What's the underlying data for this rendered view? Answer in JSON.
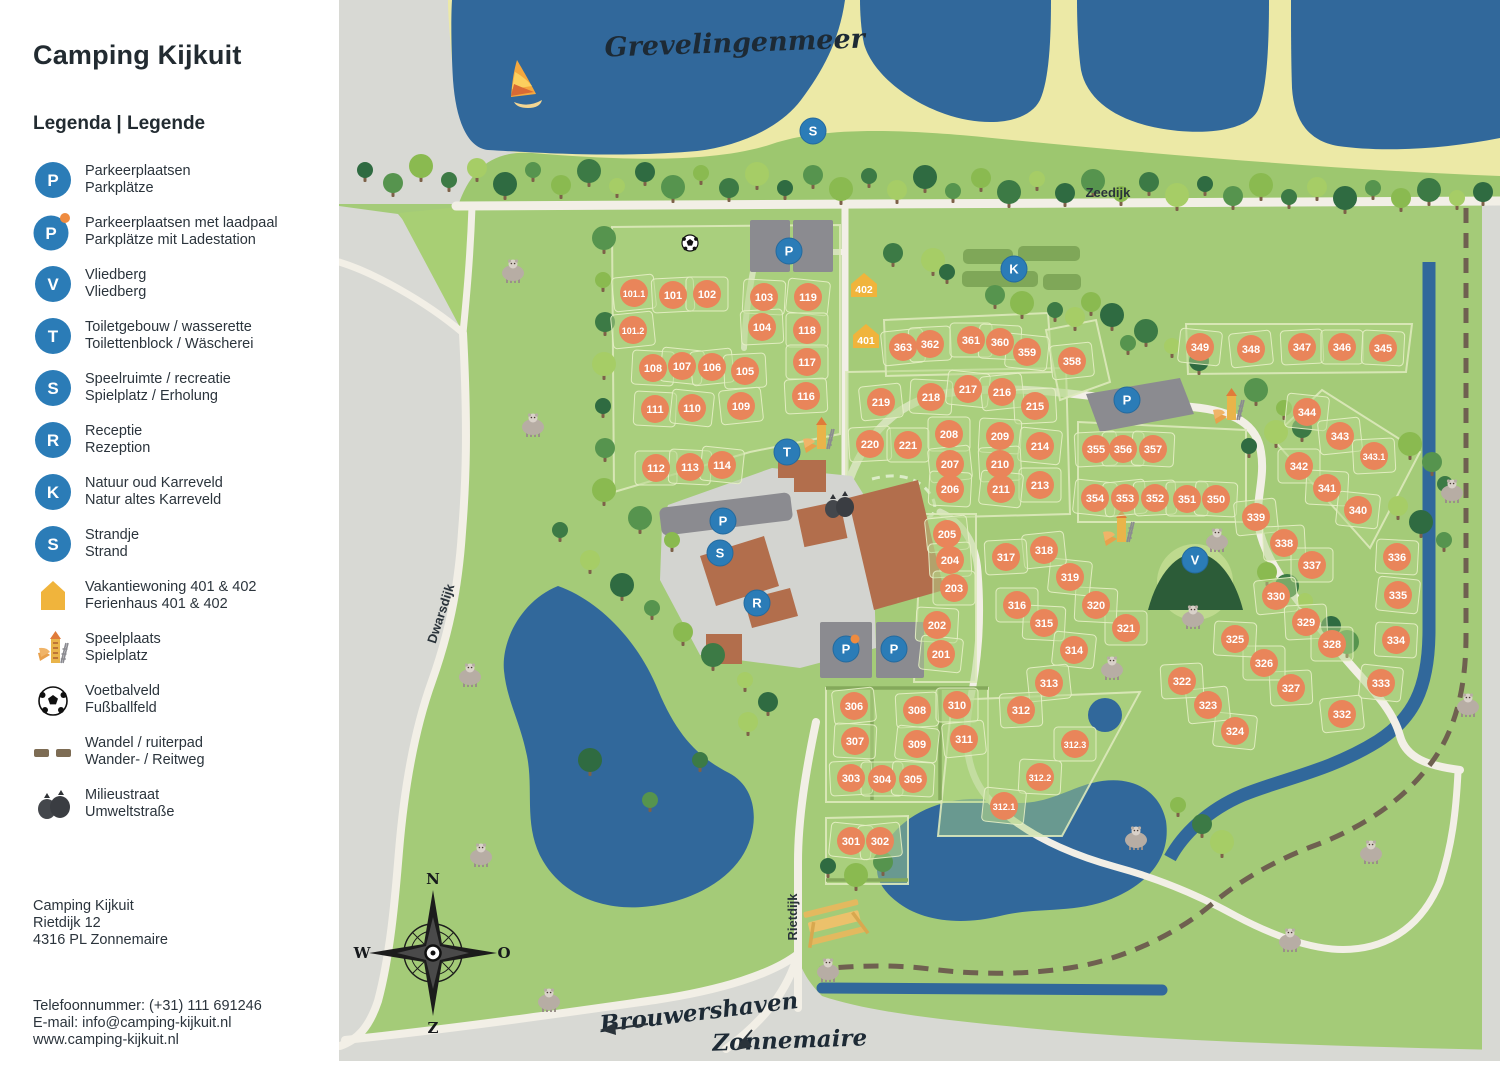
{
  "sidebar": {
    "title": "Camping Kijkuit",
    "legend_title": "Legenda | Legende",
    "items": [
      {
        "key": "parking",
        "icon": "badge",
        "letter": "P",
        "line1": "Parkeerplaatsen",
        "line2": "Parkplätze"
      },
      {
        "key": "parking-charging",
        "icon": "badge-dot",
        "letter": "P",
        "line1": "Parkeerplaatsen met laadpaal",
        "line2": "Parkplätze mit Ladestation"
      },
      {
        "key": "vliedberg",
        "icon": "badge",
        "letter": "V",
        "line1": "Vliedberg",
        "line2": "Vliedberg"
      },
      {
        "key": "toilets",
        "icon": "badge",
        "letter": "T",
        "line1": "Toiletgebouw / wasserette",
        "line2": "Toilettenblock / Wäscherei"
      },
      {
        "key": "recreation",
        "icon": "badge",
        "letter": "S",
        "line1": "Speelruimte / recreatie",
        "line2": "Spielplatz / Erholung"
      },
      {
        "key": "reception",
        "icon": "badge",
        "letter": "R",
        "line1": "Receptie",
        "line2": "Rezeption"
      },
      {
        "key": "karreveld",
        "icon": "badge",
        "letter": "K",
        "line1": "Natuur oud Karreveld",
        "line2": "Natur altes Karreveld"
      },
      {
        "key": "beach",
        "icon": "badge",
        "letter": "S",
        "line1": "Strandje",
        "line2": "Strand"
      },
      {
        "key": "holiday-home",
        "icon": "house",
        "letter": "",
        "line1": "Vakantiewoning 401 & 402",
        "line2": "Ferienhaus 401 & 402"
      },
      {
        "key": "playground",
        "icon": "playground",
        "letter": "",
        "line1": "Speelplaats",
        "line2": "Spielplatz"
      },
      {
        "key": "football-field",
        "icon": "soccer",
        "letter": "",
        "line1": "Voetbalveld",
        "line2": "Fußballfeld"
      },
      {
        "key": "bridle-path",
        "icon": "dashes",
        "letter": "",
        "line1": "Wandel / ruiterpad",
        "line2": "Wander- / Reitweg"
      },
      {
        "key": "waste-street",
        "icon": "trash",
        "letter": "",
        "line1": "Milieustraat",
        "line2": "Umweltstraße"
      }
    ],
    "address": [
      "Camping Kijkuit",
      "Rietdijk 12",
      "4316 PL Zonnemaire"
    ],
    "contact": [
      "Telefoonnummer: (+31) 111 691246",
      "E-mail: info@camping-kijkuit.nl",
      "www.camping-kijkuit.nl"
    ]
  },
  "map": {
    "labels": {
      "grevelingenmeer": "Grevelingenmeer",
      "zeedijk": "Zeedijk",
      "dwarsdijk": "Dwarsdijk",
      "rietdijk": "Rietdijk",
      "brouwershaven": "Brouwershaven",
      "zonnemaire": "Zonnemaire"
    },
    "compass": {
      "n": "N",
      "e": "O",
      "s": "Z",
      "w": "W"
    },
    "colors": {
      "water": "#31689b",
      "green": "#a4cb78",
      "dike_green": "#9dc76f",
      "sand": "#ece9a6",
      "outside_grey": "#d8d9d4",
      "road": "#f2efe6",
      "plot_orange": "#e9855a",
      "badge_blue": "#2b7cb7",
      "charge_dot": "#ef8b3f",
      "house_yellow": "#f0b43c",
      "building_brown": "#b26e4c",
      "parking_grey": "#8b8b90",
      "bridle_brown": "#6f6050",
      "hedge": "#7fa758",
      "vliedberg": "#2c5c38"
    },
    "plots": [
      [
        "101.1",
        634,
        293
      ],
      [
        "101",
        673,
        295
      ],
      [
        "102",
        707,
        294
      ],
      [
        "103",
        764,
        297
      ],
      [
        "119",
        808,
        297
      ],
      [
        "101.2",
        633,
        330
      ],
      [
        "104",
        762,
        327
      ],
      [
        "118",
        807,
        330
      ],
      [
        "108",
        653,
        368
      ],
      [
        "107",
        682,
        366
      ],
      [
        "106",
        712,
        367
      ],
      [
        "105",
        745,
        371
      ],
      [
        "117",
        807,
        362
      ],
      [
        "111",
        655,
        409
      ],
      [
        "110",
        692,
        408
      ],
      [
        "109",
        741,
        406
      ],
      [
        "116",
        806,
        396
      ],
      [
        "112",
        656,
        468
      ],
      [
        "113",
        690,
        467
      ],
      [
        "114",
        722,
        465
      ],
      [
        "219",
        881,
        402
      ],
      [
        "220",
        870,
        444
      ],
      [
        "221",
        908,
        445
      ],
      [
        "218",
        931,
        397
      ],
      [
        "217",
        968,
        389
      ],
      [
        "216",
        1002,
        392
      ],
      [
        "215",
        1035,
        406
      ],
      [
        "208",
        949,
        434
      ],
      [
        "209",
        1000,
        436
      ],
      [
        "214",
        1040,
        446
      ],
      [
        "207",
        950,
        464
      ],
      [
        "210",
        1000,
        464
      ],
      [
        "213",
        1040,
        485
      ],
      [
        "206",
        950,
        489
      ],
      [
        "211",
        1001,
        489
      ],
      [
        "205",
        947,
        534
      ],
      [
        "204",
        950,
        560
      ],
      [
        "203",
        954,
        588
      ],
      [
        "202",
        937,
        625
      ],
      [
        "201",
        941,
        654
      ],
      [
        "363",
        903,
        347
      ],
      [
        "362",
        930,
        344
      ],
      [
        "361",
        971,
        340
      ],
      [
        "360",
        1000,
        342
      ],
      [
        "359",
        1027,
        352
      ],
      [
        "358",
        1072,
        361
      ],
      [
        "355",
        1096,
        449
      ],
      [
        "356",
        1123,
        449
      ],
      [
        "357",
        1153,
        449
      ],
      [
        "354",
        1095,
        498
      ],
      [
        "353",
        1125,
        498
      ],
      [
        "352",
        1155,
        498
      ],
      [
        "351",
        1187,
        499
      ],
      [
        "350",
        1216,
        499
      ],
      [
        "349",
        1200,
        347
      ],
      [
        "348",
        1251,
        349
      ],
      [
        "347",
        1302,
        347
      ],
      [
        "346",
        1342,
        347
      ],
      [
        "345",
        1383,
        348
      ],
      [
        "344",
        1307,
        412
      ],
      [
        "343",
        1340,
        436
      ],
      [
        "343.1",
        1374,
        456
      ],
      [
        "342",
        1299,
        466
      ],
      [
        "341",
        1327,
        488
      ],
      [
        "340",
        1358,
        510
      ],
      [
        "339",
        1256,
        517
      ],
      [
        "338",
        1284,
        543
      ],
      [
        "337",
        1312,
        565
      ],
      [
        "336",
        1397,
        557
      ],
      [
        "335",
        1398,
        595
      ],
      [
        "330",
        1276,
        596
      ],
      [
        "329",
        1306,
        622
      ],
      [
        "328",
        1332,
        644
      ],
      [
        "334",
        1396,
        640
      ],
      [
        "333",
        1381,
        683
      ],
      [
        "332",
        1342,
        714
      ],
      [
        "327",
        1291,
        688
      ],
      [
        "326",
        1264,
        663
      ],
      [
        "325",
        1235,
        639
      ],
      [
        "324",
        1235,
        731
      ],
      [
        "323",
        1208,
        705
      ],
      [
        "322",
        1182,
        681
      ],
      [
        "321",
        1126,
        628
      ],
      [
        "320",
        1096,
        605
      ],
      [
        "319",
        1070,
        577
      ],
      [
        "318",
        1044,
        550
      ],
      [
        "317",
        1006,
        557
      ],
      [
        "316",
        1017,
        605
      ],
      [
        "315",
        1044,
        623
      ],
      [
        "314",
        1074,
        650
      ],
      [
        "313",
        1049,
        683
      ],
      [
        "312",
        1021,
        710
      ],
      [
        "312.3",
        1075,
        744
      ],
      [
        "312.2",
        1040,
        777
      ],
      [
        "312.1",
        1004,
        806
      ],
      [
        "306",
        854,
        706
      ],
      [
        "308",
        917,
        710
      ],
      [
        "310",
        957,
        705
      ],
      [
        "307",
        855,
        741
      ],
      [
        "309",
        917,
        744
      ],
      [
        "311",
        964,
        739
      ],
      [
        "303",
        851,
        778
      ],
      [
        "304",
        882,
        779
      ],
      [
        "305",
        913,
        779
      ],
      [
        "301",
        851,
        841
      ],
      [
        "302",
        880,
        841
      ]
    ],
    "holiday_homes": [
      [
        "402",
        864,
        287
      ],
      [
        "401",
        866,
        338
      ]
    ],
    "badges": [
      {
        "letter": "S",
        "x": 813,
        "y": 131,
        "name": "beach"
      },
      {
        "letter": "P",
        "x": 789,
        "y": 251,
        "name": "parking-north"
      },
      {
        "letter": "K",
        "x": 1014,
        "y": 269,
        "name": "karreveld"
      },
      {
        "letter": "P",
        "x": 1127,
        "y": 400,
        "name": "parking-east"
      },
      {
        "letter": "T",
        "x": 787,
        "y": 452,
        "name": "toilets"
      },
      {
        "letter": "P",
        "x": 723,
        "y": 521,
        "name": "parking-plaza"
      },
      {
        "letter": "S",
        "x": 720,
        "y": 553,
        "name": "recreation"
      },
      {
        "letter": "R",
        "x": 757,
        "y": 603,
        "name": "reception"
      },
      {
        "letter": "P",
        "x": 846,
        "y": 649,
        "dot": true,
        "name": "parking-charging"
      },
      {
        "letter": "P",
        "x": 894,
        "y": 649,
        "name": "parking-south"
      },
      {
        "letter": "V",
        "x": 1195,
        "y": 560,
        "name": "vliedberg"
      }
    ],
    "trees": [
      [
        365,
        170
      ],
      [
        393,
        183
      ],
      [
        421,
        166
      ],
      [
        449,
        180
      ],
      [
        477,
        168
      ],
      [
        505,
        184
      ],
      [
        533,
        170
      ],
      [
        561,
        185
      ],
      [
        589,
        171
      ],
      [
        617,
        186
      ],
      [
        645,
        172
      ],
      [
        673,
        187
      ],
      [
        701,
        173
      ],
      [
        729,
        188
      ],
      [
        757,
        174
      ],
      [
        785,
        188
      ],
      [
        813,
        175
      ],
      [
        841,
        189
      ],
      [
        869,
        176
      ],
      [
        897,
        190
      ],
      [
        925,
        177
      ],
      [
        953,
        191
      ],
      [
        981,
        178
      ],
      [
        1009,
        192
      ],
      [
        1037,
        179
      ],
      [
        1065,
        193
      ],
      [
        1093,
        181
      ],
      [
        1121,
        194
      ],
      [
        1149,
        182
      ],
      [
        1177,
        195
      ],
      [
        1205,
        184
      ],
      [
        1233,
        196
      ],
      [
        1261,
        185
      ],
      [
        1289,
        197
      ],
      [
        1317,
        187
      ],
      [
        1345,
        198
      ],
      [
        1373,
        188
      ],
      [
        1401,
        198
      ],
      [
        1429,
        190
      ],
      [
        1457,
        198
      ],
      [
        1483,
        192
      ],
      [
        604,
        238
      ],
      [
        603,
        280
      ],
      [
        605,
        322
      ],
      [
        604,
        364
      ],
      [
        603,
        406
      ],
      [
        605,
        448
      ],
      [
        604,
        490
      ],
      [
        560,
        530
      ],
      [
        590,
        560
      ],
      [
        622,
        585
      ],
      [
        652,
        608
      ],
      [
        683,
        632
      ],
      [
        713,
        655
      ],
      [
        745,
        680
      ],
      [
        768,
        702
      ],
      [
        640,
        518
      ],
      [
        672,
        540
      ],
      [
        893,
        253
      ],
      [
        933,
        260
      ],
      [
        947,
        272
      ],
      [
        995,
        295
      ],
      [
        1022,
        303
      ],
      [
        1055,
        310
      ],
      [
        1075,
        317
      ],
      [
        1112,
        315
      ],
      [
        1128,
        343
      ],
      [
        1091,
        302
      ],
      [
        1146,
        331
      ],
      [
        1172,
        346
      ],
      [
        1199,
        361
      ],
      [
        1256,
        390
      ],
      [
        1284,
        408
      ],
      [
        1302,
        428
      ],
      [
        1276,
        432
      ],
      [
        1249,
        446
      ],
      [
        1432,
        462
      ],
      [
        1410,
        444
      ],
      [
        1445,
        484
      ],
      [
        1398,
        506
      ],
      [
        1421,
        522
      ],
      [
        1444,
        540
      ],
      [
        1267,
        572
      ],
      [
        1287,
        586
      ],
      [
        1305,
        601
      ],
      [
        1331,
        626
      ],
      [
        1347,
        642
      ],
      [
        1178,
        805
      ],
      [
        1202,
        824
      ],
      [
        1222,
        842
      ],
      [
        828,
        866
      ],
      [
        883,
        862
      ],
      [
        856,
        875
      ],
      [
        700,
        760
      ],
      [
        748,
        722
      ],
      [
        590,
        760
      ],
      [
        650,
        800
      ]
    ],
    "sheep": [
      [
        513,
        272
      ],
      [
        533,
        426
      ],
      [
        470,
        676
      ],
      [
        481,
        856
      ],
      [
        1452,
        492
      ],
      [
        1217,
        541
      ],
      [
        1193,
        618
      ],
      [
        1112,
        669
      ],
      [
        1468,
        706
      ],
      [
        828,
        971
      ],
      [
        1136,
        839
      ],
      [
        1290,
        941
      ],
      [
        1371,
        853
      ],
      [
        549,
        1001
      ]
    ],
    "playgrounds": [
      [
        820,
        437
      ],
      [
        1120,
        530
      ],
      [
        1230,
        408
      ]
    ],
    "features": {
      "soccer": {
        "x": 690,
        "y": 243
      },
      "windsurfer": {
        "x": 524,
        "y": 82
      },
      "trash": {
        "x": 838,
        "y": 507
      },
      "picnic": {
        "x": 835,
        "y": 925
      },
      "pond": {
        "x": 1105,
        "y": 715,
        "r": 17
      }
    }
  }
}
